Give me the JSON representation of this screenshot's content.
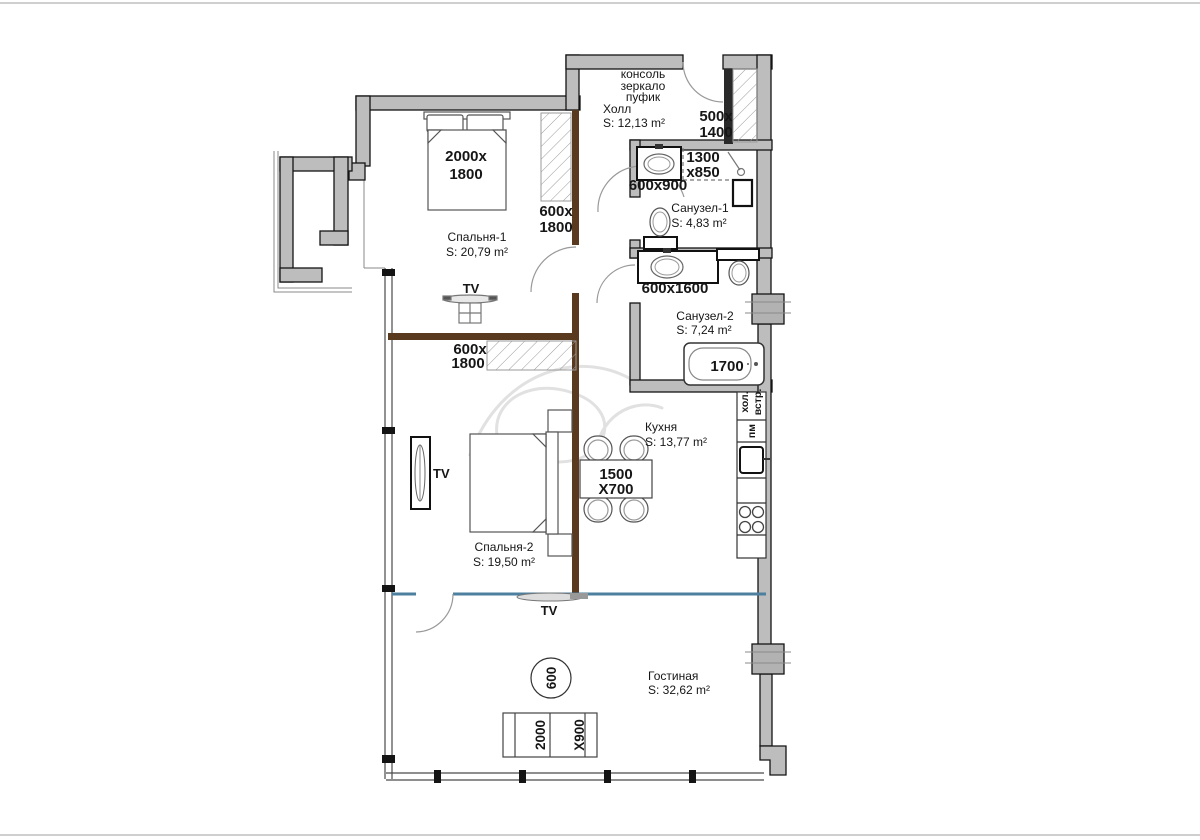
{
  "colors": {
    "wall": "#bdbdbd",
    "wood": "#5a3a1e",
    "glass": "#4d7f9e"
  },
  "rooms": {
    "hall": {
      "name": "Холл",
      "area": "S: 12,13 m²"
    },
    "bedroom1": {
      "name": "Спальня-1",
      "area": "S: 20,79 m²"
    },
    "bathroom1": {
      "name": "Санузел-1",
      "area": "S: 4,83 m²"
    },
    "bathroom2": {
      "name": "Санузел-2",
      "area": "S: 7,24 m²"
    },
    "kitchen": {
      "name": "Кухня",
      "area": "S: 13,77 m²"
    },
    "bedroom2": {
      "name": "Спальня-2",
      "area": "S: 19,50 m²"
    },
    "living": {
      "name": "Гостиная",
      "area": "S: 32,62 m²"
    }
  },
  "hall_furniture": {
    "line1": "консоль",
    "line2": "зеркало",
    "line3": "пуфик"
  },
  "dims": {
    "hall_closet_w": "500x",
    "hall_closet_h": "1400",
    "bed1_w": "2000x",
    "bed1_h": "1800",
    "wardrobe1_w": "600x",
    "wardrobe1_h": "1800",
    "shower_w": "1300",
    "shower_h": "x850",
    "sink1": "600x900",
    "sink2": "600x1600",
    "bathtub": "1700",
    "wardrobe2_w": "600x",
    "wardrobe2_h": "1800",
    "table_w": "1500",
    "table_h": "X700",
    "column": "600",
    "bench_w": "2000",
    "bench_h": "X900"
  },
  "kitchen_units": {
    "fridge_line1": "хол.",
    "fridge_line2": "встр.",
    "dishwasher": "пм"
  },
  "tv_labels": {
    "bedroom1": "TV",
    "bedroom2": "TV",
    "living": "TV"
  }
}
